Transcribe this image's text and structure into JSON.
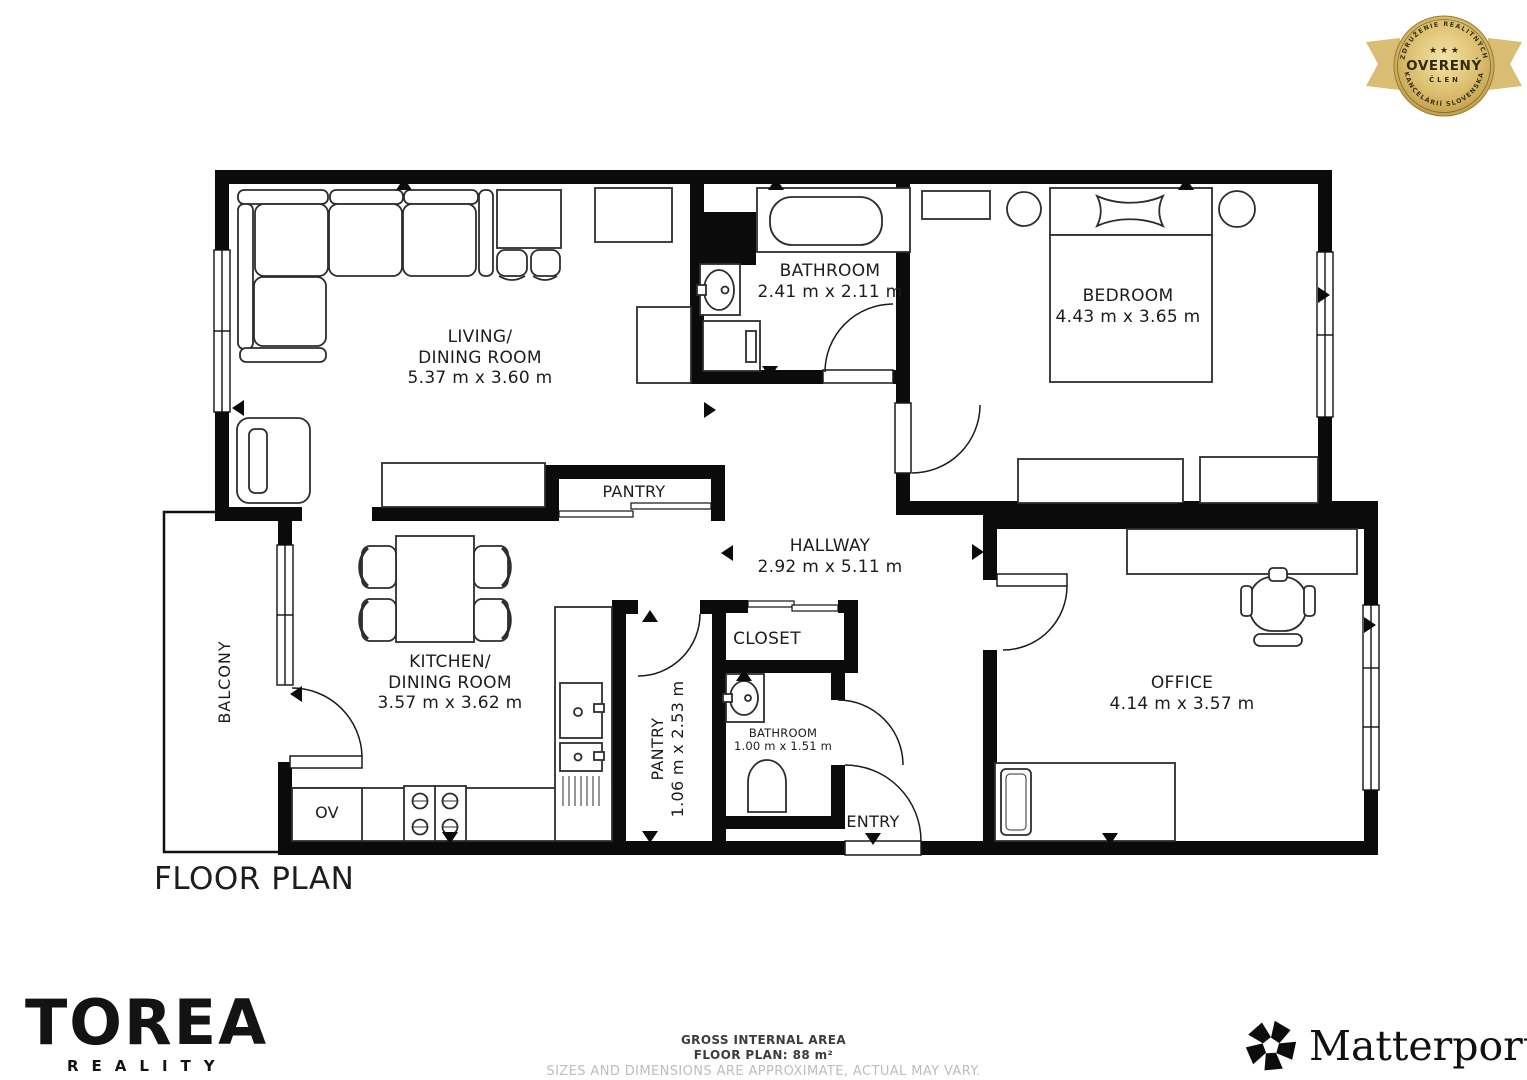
{
  "badge": {
    "arc_top": "ZDRUŽENIE REALITNÝCH",
    "arc_bottom": "KANCELÁRIÍ SLOVENSKA",
    "stars": "★ ★ ★",
    "title": "OVERENÝ",
    "subtitle": "ČLEN",
    "gold_color": "#c9a84c"
  },
  "plan": {
    "heading": "FLOOR PLAN",
    "rooms": {
      "living": {
        "name1": "LIVING/",
        "name2": "DINING ROOM",
        "dims": "5.37 m x 3.60 m"
      },
      "bathroom": {
        "name": "BATHROOM",
        "dims": "2.41 m x 2.11 m"
      },
      "bedroom": {
        "name": "BEDROOM",
        "dims": "4.43 m x 3.65 m"
      },
      "pantry_top": {
        "name": "PANTRY"
      },
      "hallway": {
        "name": "HALLWAY",
        "dims": "2.92 m x 5.11 m"
      },
      "kitchen": {
        "name1": "KITCHEN/",
        "name2": "DINING ROOM",
        "dims": "3.57 m x 3.62 m"
      },
      "closet": {
        "name": "CLOSET"
      },
      "pantry": {
        "name": "PANTRY",
        "dims": "1.06 m x 2.53 m"
      },
      "bathroom_small": {
        "name": "BATHROOM",
        "dims": "1.00 m x 1.51 m"
      },
      "office": {
        "name": "OFFICE",
        "dims": "4.14 m x 3.57 m"
      },
      "balcony": {
        "name": "BALCONY"
      },
      "entry": {
        "name": "ENTRY"
      },
      "oven": {
        "name": "OV"
      }
    }
  },
  "footer": {
    "area_line1": "GROSS INTERNAL AREA",
    "area_line2": "FLOOR PLAN: 88 m²",
    "disclaimer": "SIZES AND DIMENSIONS ARE APPROXIMATE, ACTUAL MAY VARY.",
    "brand_name": "TOREA",
    "brand_sub": "REALITY",
    "matterport": "Matterport",
    "matterport_reg": "®"
  }
}
